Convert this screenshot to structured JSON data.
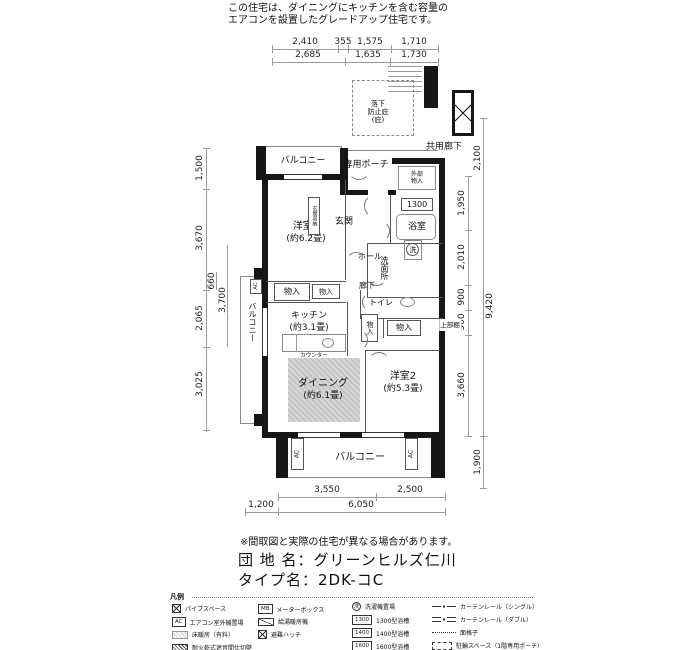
{
  "note": {
    "line1": "この住宅は、ダイニングにキッチンを含む容量の",
    "line2": "エアコンを設置したグレードアップ住宅です。"
  },
  "rooms": {
    "balcony_top": "バルコニー",
    "porch": "専用ポーチ",
    "common_corridor": "共用廊下",
    "canopy": {
      "l1": "落下",
      "l2": "防止庇",
      "l3": "(庇)"
    },
    "yoshitsu1": {
      "name": "洋室1",
      "size": "(約6.2畳)"
    },
    "genkan": "玄関",
    "genkan_storage": "玄関収納",
    "outer_storage": {
      "l1": "外部",
      "l2": "物入"
    },
    "bathroom": "浴室",
    "bath_model": "1300",
    "hall": "ホール",
    "washroom": "洗面所",
    "laundry": "洗",
    "corridor": "廊下",
    "toilet": "トイレ",
    "storage1": "物入",
    "storage2": "物入",
    "storage3": "物入",
    "storage4": "物入",
    "kitchen": {
      "name": "キッチン",
      "size": "(約3.1畳)"
    },
    "counter": "カウンター",
    "dining": {
      "name": "ダイニング",
      "size": "(約6.1畳)"
    },
    "yoshitsu2": {
      "name": "洋室2",
      "size": "(約5.3畳)"
    },
    "balcony_bottom": "バルコニー",
    "balcony_left": "バルコニー",
    "upper_shelf": "上部棚",
    "ac_label": "AC"
  },
  "dims": {
    "top1": [
      "2,410",
      "355",
      "1,575",
      "1,710"
    ],
    "top2": [
      "2,685",
      "1,635",
      "1,730"
    ],
    "left": [
      "1,500",
      "3,670",
      "660",
      "3,700",
      "2,065",
      "3,025"
    ],
    "right": [
      "2,100",
      "1,950",
      "2,010",
      "900",
      "900",
      "3,660",
      "9,420",
      "1,900"
    ],
    "bottom1": [
      "3,550",
      "2,500"
    ],
    "bottom2": [
      "1,200",
      "6,050"
    ]
  },
  "footer": {
    "disclaimer": "※間取図と実際の住宅が異なる場合があります。",
    "estate_label": "団 地 名：グリーンヒルズ仁川",
    "type_label": "タイプ名：2DK-コC"
  },
  "legend": {
    "title": "凡例",
    "col1": [
      {
        "label": "パイプスペース"
      },
      {
        "icon_text": "AC",
        "label": "エアコン室外機置場"
      },
      {
        "label": "床暖房（有料）"
      },
      {
        "label": "耐火乾式遮音間仕切壁"
      }
    ],
    "col2": [
      {
        "icon_text": "MB",
        "label": "メーターボックス"
      },
      {
        "label": "給湯暖房機"
      },
      {
        "label": "避難ハッチ"
      }
    ],
    "col3": [
      {
        "icon_text": "洗",
        "label": "洗濯機置場"
      },
      {
        "icon_text": "1300",
        "label": "1300型浴槽"
      },
      {
        "icon_text": "1400",
        "label": "1400型浴槽"
      },
      {
        "icon_text": "1600",
        "label": "1600型浴槽"
      }
    ],
    "col4": [
      {
        "label": "カーテンレール（シングル）"
      },
      {
        "label": "カーテンレール（ダブル）"
      },
      {
        "label": "面格子"
      },
      {
        "label": "駐輪スペース（1階専用ポーチ）"
      }
    ]
  }
}
